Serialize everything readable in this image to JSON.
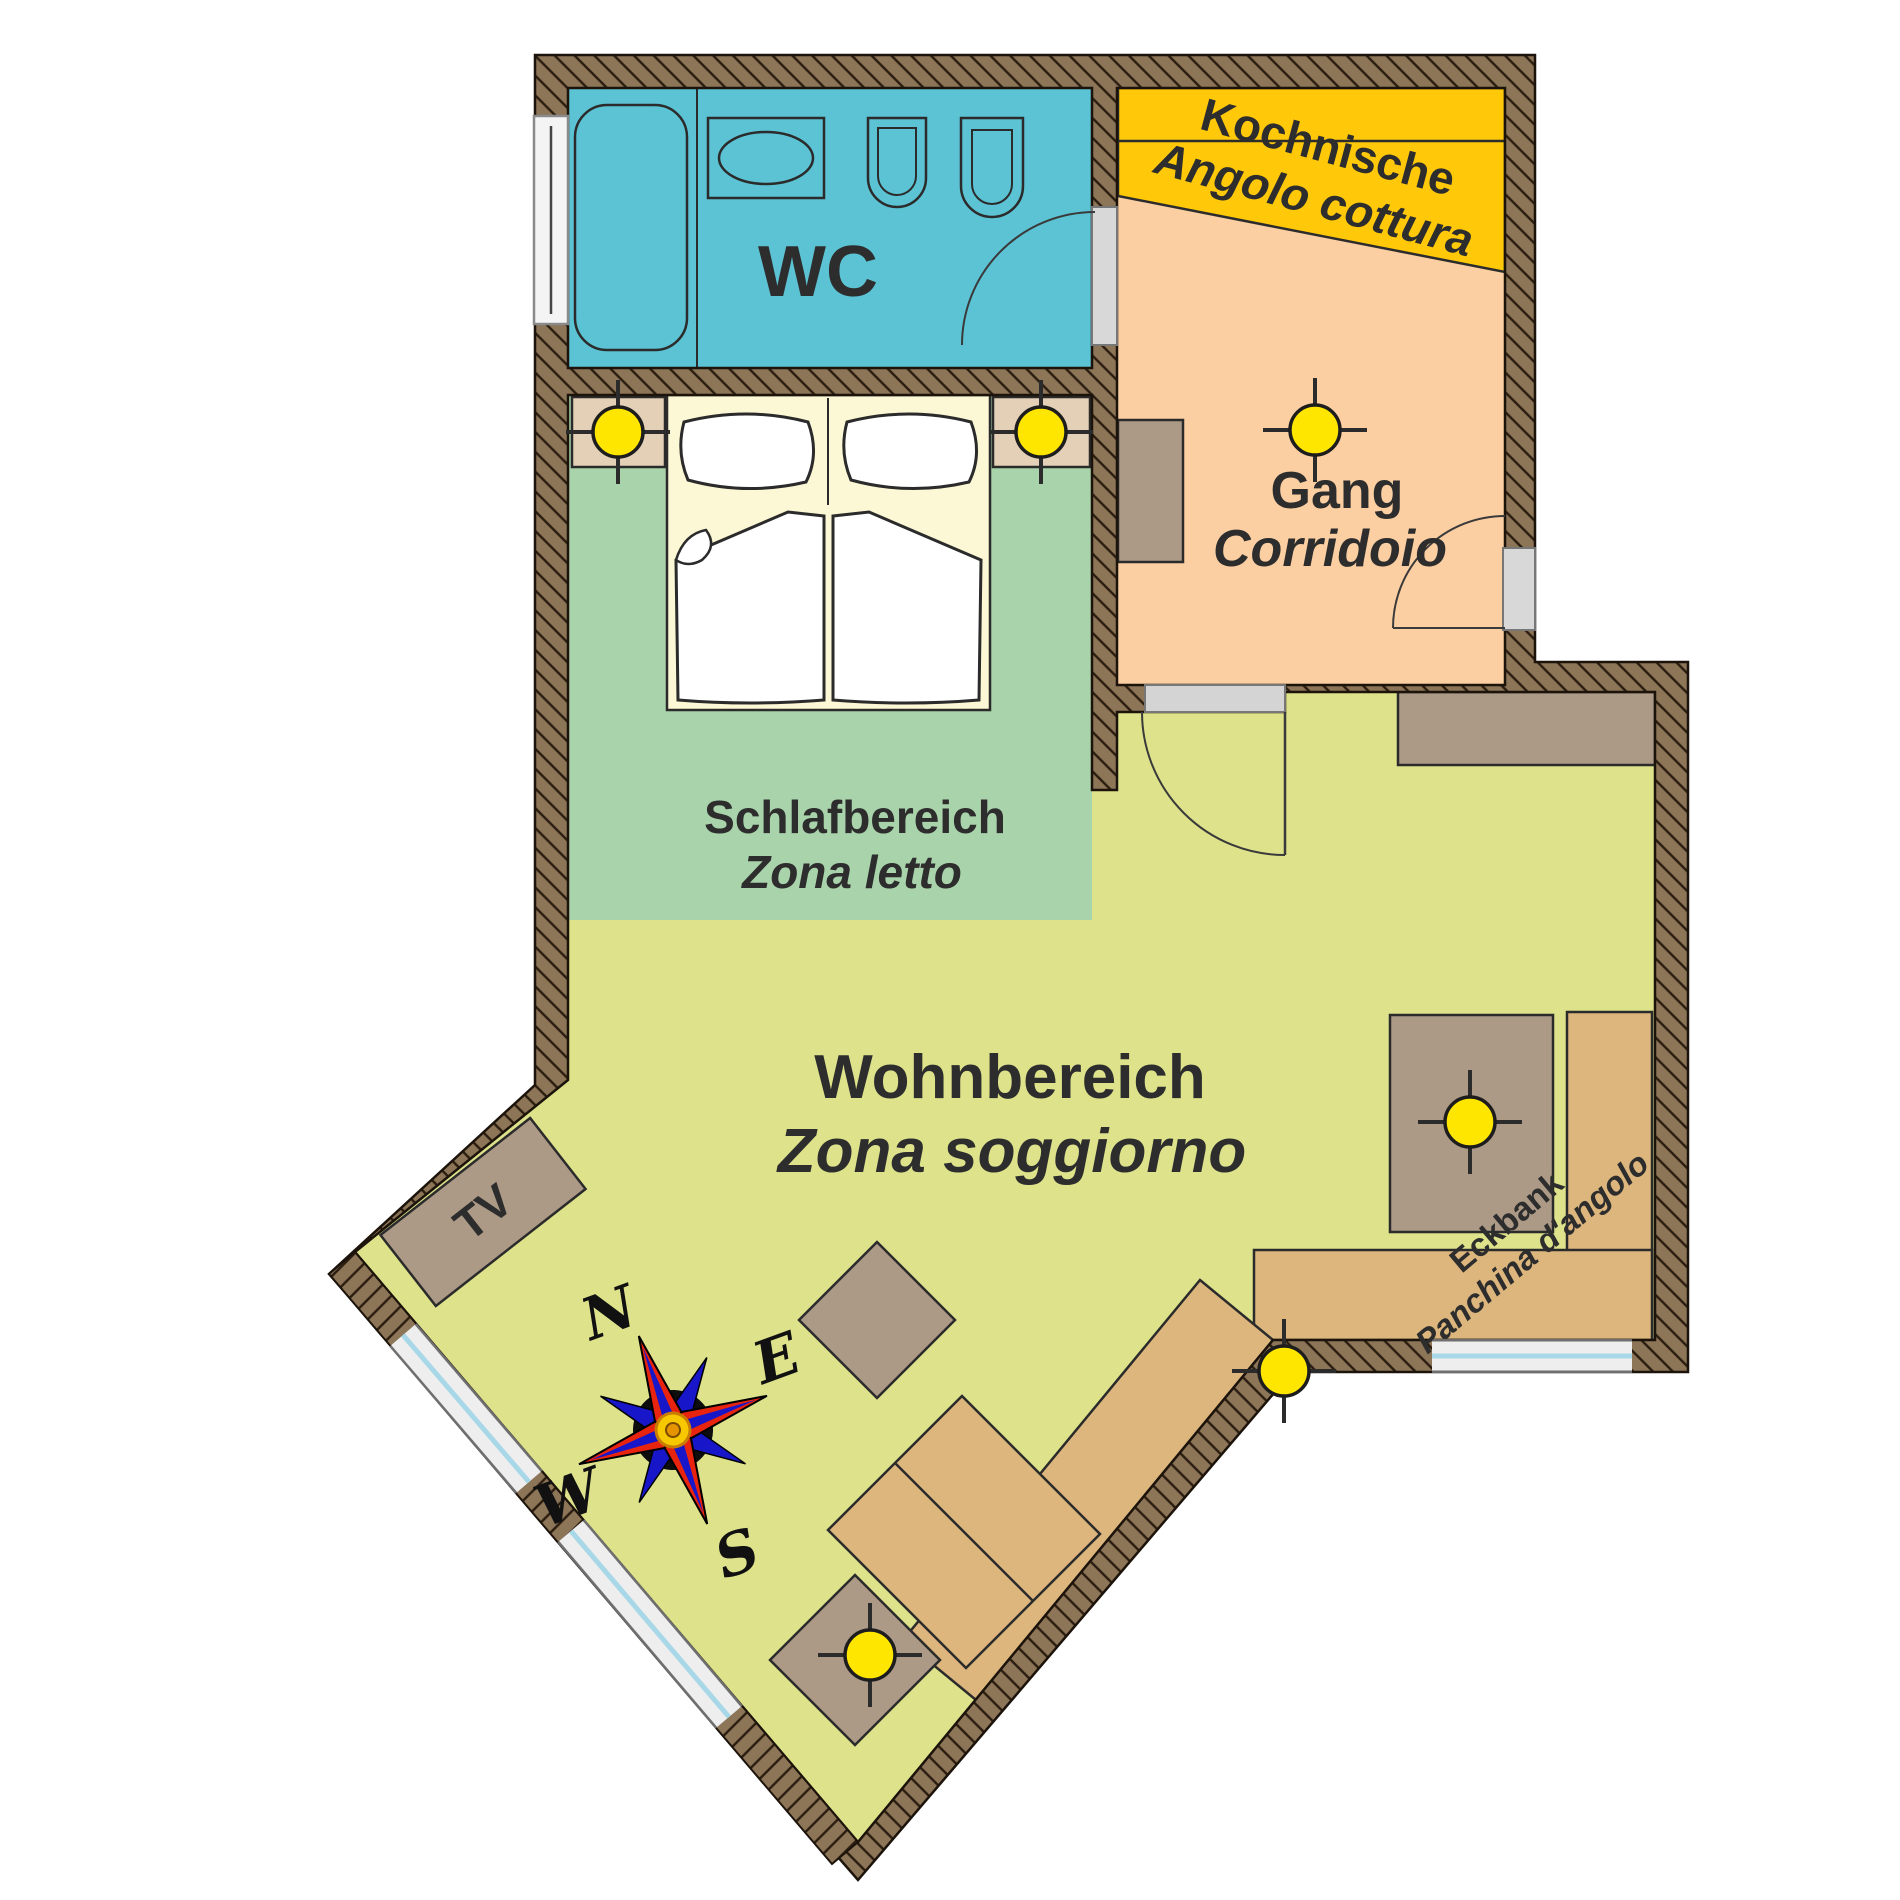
{
  "title": "Apartment floor plan (Wohnung Grundriss)",
  "rooms": {
    "wc": {
      "label": "WC"
    },
    "kitchen": {
      "label_de": "Kochnische",
      "label_it": "Angolo cottura"
    },
    "corridor": {
      "label_de": "Gang",
      "label_it": "Corridoio"
    },
    "sleeping": {
      "label_de": "Schlafbereich",
      "label_it": "Zona letto"
    },
    "living": {
      "label_de": "Wohnbereich",
      "label_it": "Zona soggiorno"
    }
  },
  "furniture": {
    "tv": {
      "label": "TV"
    },
    "corner_bench": {
      "label_de": "Eckbank",
      "label_it": "Panchina d'angolo"
    }
  },
  "compass": {
    "north": "N",
    "east": "E",
    "south": "S",
    "west": "W"
  },
  "icons": {
    "ceiling_light": "circle-with-crosshair",
    "compass_rose": "eight-point-star",
    "bathtub": "rounded-rect-tub",
    "washbasin": "oval-in-rect",
    "toilet": "u-shape",
    "bidet": "u-shape"
  },
  "colors": {
    "wall": "#8d7557",
    "wc_floor": "#5cc3d4",
    "corridor_floor": "#fbcfa2",
    "kitchen_band": "#ffc90a",
    "sleeping_floor": "#a9d3ab",
    "living_floor": "#dde28b",
    "bed": "#fcf7d4",
    "nightstand": "#e3d0b6",
    "furniture_brown": "#ac9a87",
    "bench_tan": "#dcb67d",
    "light_yellow": "#ffe600",
    "door_gray": "#d8d8d8",
    "window_glass": "#a8d8e8"
  },
  "counts": {
    "ceiling_lights": "6"
  }
}
